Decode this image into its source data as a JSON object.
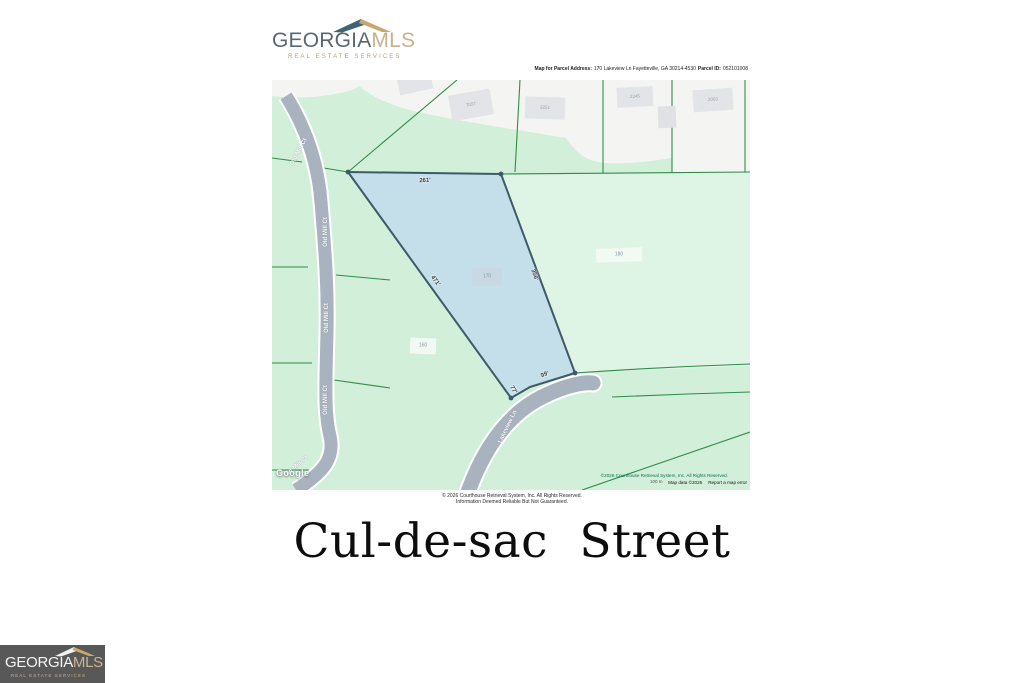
{
  "brand": {
    "primary": "GEORGIA",
    "secondary": "MLS",
    "tagline": "REAL ESTATE SERVICES"
  },
  "parcel_header": {
    "address_label": "Map for Parcel Address:",
    "address": "170 Lakeview Ln Fayetteville, GA 30214-4530",
    "parcel_id_label": "Parcel ID:",
    "parcel_id": "052101008"
  },
  "map": {
    "buildings": [
      "7057",
      "2251",
      "2345",
      "2003"
    ],
    "lots": {
      "subject": "170",
      "west": "160",
      "east": "180"
    },
    "dimensions": {
      "top": "261'",
      "left": "471'",
      "right": "356'",
      "bottom": "99'",
      "corner": "77'"
    },
    "roads": {
      "old_mill": [
        "Old Mill Ct",
        "Old Mill Ct",
        "Old Mill Ct",
        "Old Mill Ct",
        "Old Mill Ct"
      ],
      "lakeview": "Lakeview Ln"
    },
    "watermark": "Google",
    "scale": "100 m",
    "credits": {
      "line1": "©2026 Courthouse Retrieval System, Inc. All Rights Reserved.",
      "line2": "Map data ©2026",
      "error_link": "Report a map error"
    }
  },
  "disclaimer": {
    "line1": "© 2026 Courthouse Retrieval System, Inc. All Rights Reserved.",
    "line2": "Information Deemed Reliable But Not Guaranteed."
  },
  "caption": "Cul-de-sac Street",
  "colors": {
    "map_green": "#d2efda",
    "parcel_blue": "#c3dee9",
    "parcel_border": "#3d5a69",
    "road_gray": "#a9b3c0",
    "line_green": "#2f8c49",
    "brand_slate": "#5a6771",
    "brand_tan": "#c6b28c",
    "badge_bg": "#585858"
  }
}
